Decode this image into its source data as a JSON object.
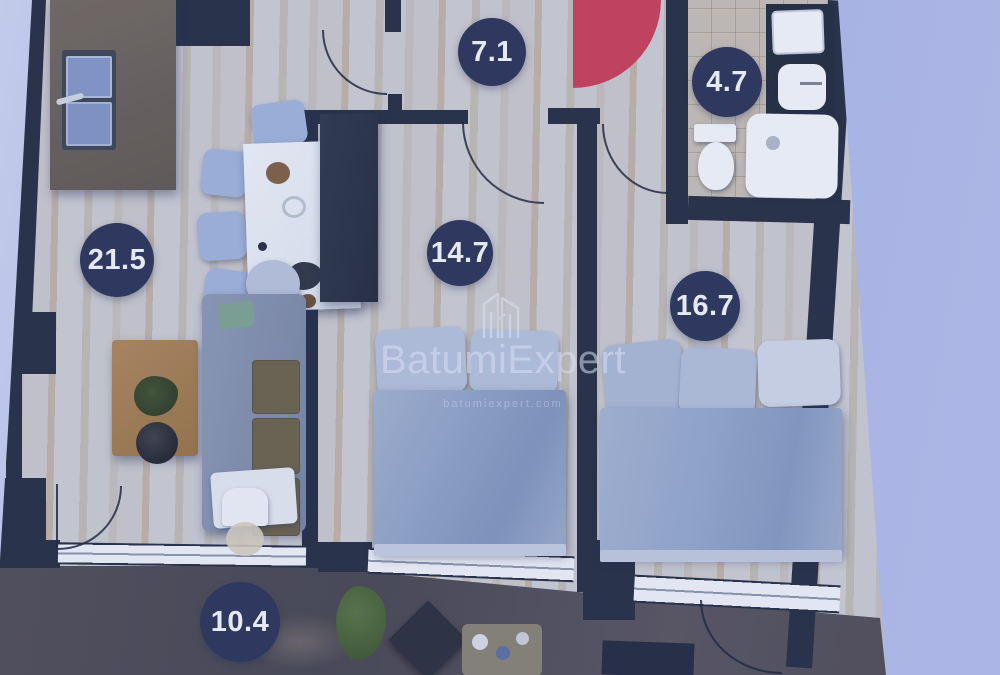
{
  "watermark": {
    "brand": "BatumiExpert",
    "website": "batumiexpert.com",
    "logo": "batumiexpert-buildings-logo-icon"
  },
  "rooms": [
    {
      "id": "hallway",
      "area_m2": "7.1"
    },
    {
      "id": "bathroom",
      "area_m2": "4.7"
    },
    {
      "id": "living-room",
      "area_m2": "21.5"
    },
    {
      "id": "bedroom-1",
      "area_m2": "14.7"
    },
    {
      "id": "bedroom-2",
      "area_m2": "16.7"
    },
    {
      "id": "balcony",
      "area_m2": "10.4"
    }
  ],
  "colors": {
    "wall": "#212a3d",
    "badge": "#272f52",
    "accent_red": "#c83b55",
    "floor_wood": "#d5d0c6",
    "balcony_marble": "#473f37",
    "background": "#aeb9e7"
  }
}
